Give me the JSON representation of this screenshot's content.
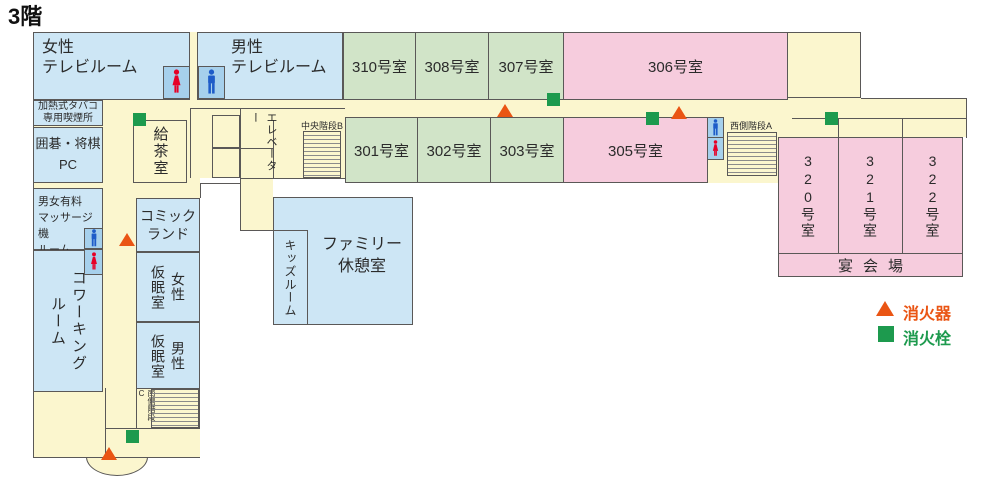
{
  "title": "3階",
  "legend": {
    "extinguisher_label": "消火器",
    "hydrant_label": "消火栓"
  },
  "colors": {
    "extinguisher": "#ea5514",
    "hydrant": "#1d9a4e",
    "room_blue": "#cde6f5",
    "room_green": "#d1e4c8",
    "room_pink": "#f6ccdd",
    "corridor_yellow": "#fbf6ce",
    "icon_box_blue": "#a6d0ec",
    "man_icon": "#1e5cc8",
    "woman_icon": "#e60027"
  },
  "icons": {
    "male_icon": "male-pictogram",
    "female_icon": "female-pictogram",
    "extinguisher_marker": "orange-triangle",
    "hydrant_marker": "green-square"
  },
  "guest_rooms": {
    "r301": "301号室",
    "r302": "302号室",
    "r303": "303号室",
    "r305": "305号室",
    "r306": "306号室",
    "r307": "307号室",
    "r308": "308号室",
    "r310": "310号室",
    "r320": "320号室",
    "r321": "321号室",
    "r322": "322号室"
  },
  "facilities": {
    "tv_women": "女性\nテレビルーム",
    "tv_men": "男性\nテレビルーム",
    "smoking": "加熱式タバコ\n専用喫煙所",
    "igo_shogi": "囲碁・将棋\nPC",
    "massage": "男女有料\nマッサージ機\nルーム",
    "coworking": "コワーキング\nルーム",
    "tea": "給茶室",
    "comic": "コミック\nランド",
    "nap_women": "女性\n仮眠室",
    "nap_men": "男性\n仮眠室",
    "kids": "キッズルーム",
    "family": "ファミリー\n休憩室",
    "banquet": "宴会場",
    "elevator": "エレベーター"
  },
  "stairs": {
    "central": "中央階段B",
    "west": "西側階段A",
    "south": "南側階段C"
  }
}
